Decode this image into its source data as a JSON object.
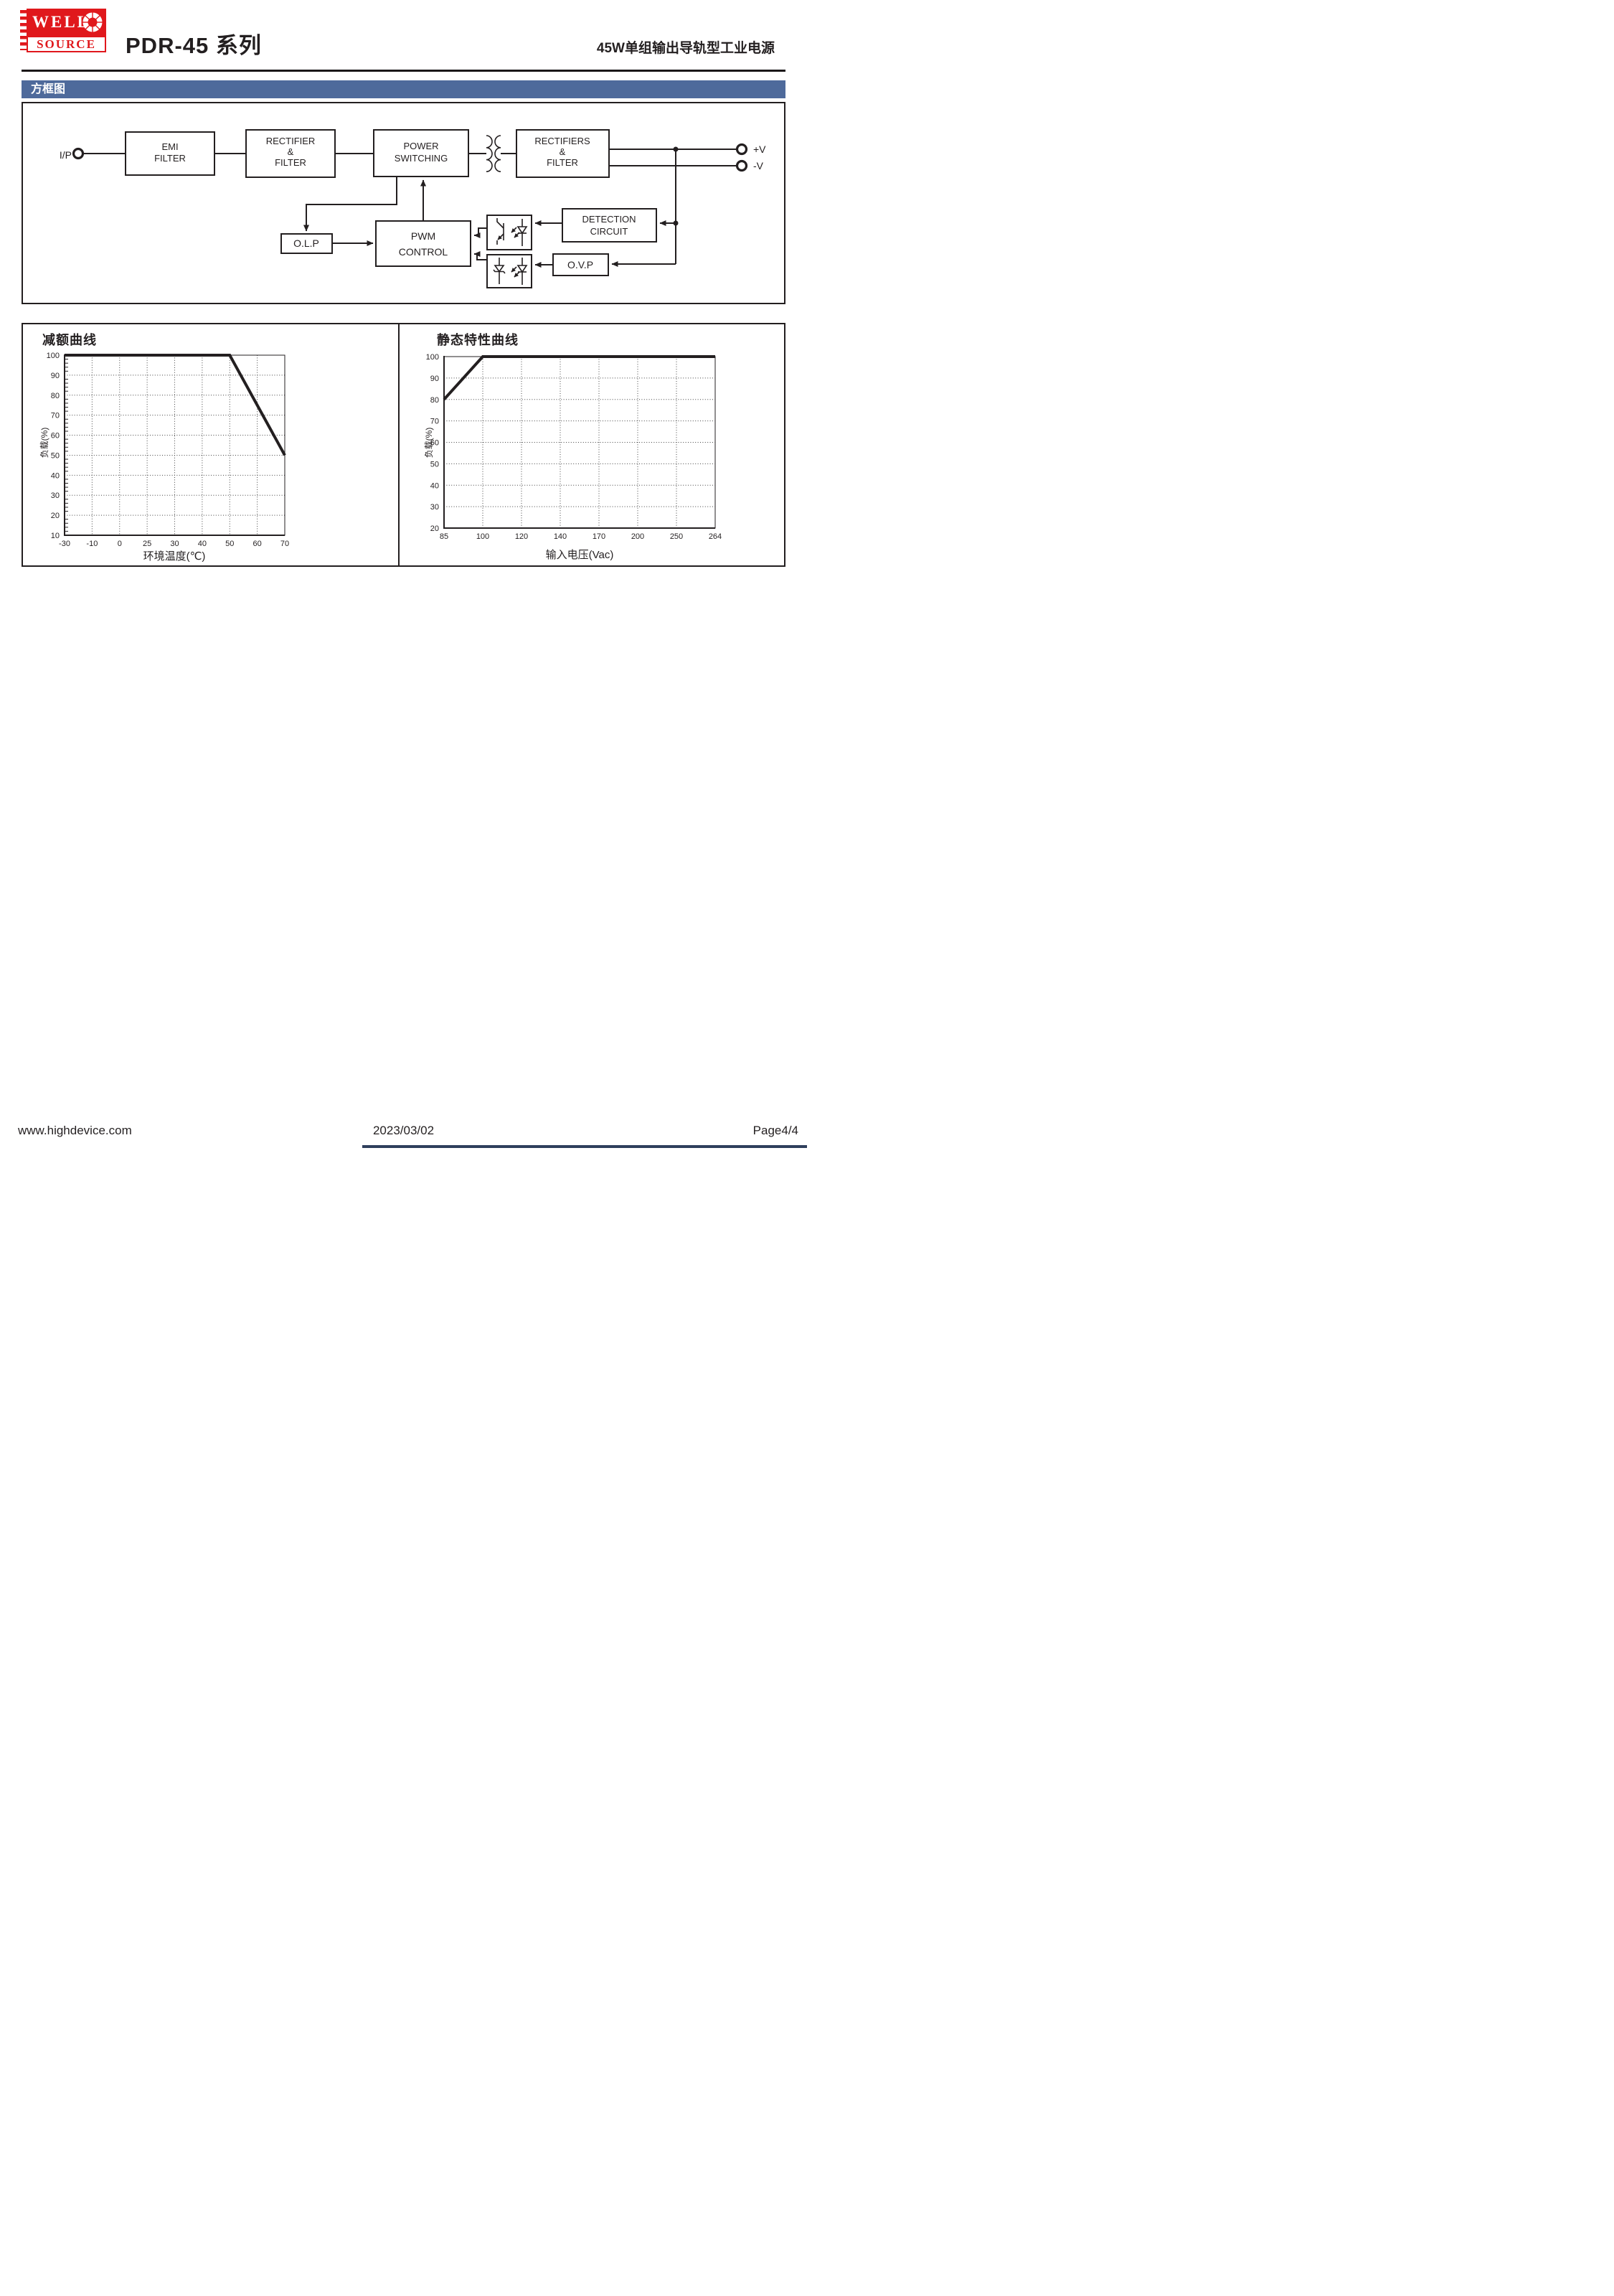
{
  "colors": {
    "ink": "#231f20",
    "banner_bg": "#4e6a9b",
    "banner_text": "#ffffff",
    "logo_red": "#e0181c",
    "grid_dots": "#444444"
  },
  "header": {
    "logo": {
      "word1": "WELL",
      "word2": "SOURCE"
    },
    "title": "PDR-45 系列",
    "subtitle": "45W单组输出导轨型工业电源"
  },
  "section_banner": "方框图",
  "diagram": {
    "input_label": "I/P",
    "emi_filter": {
      "l1": "EMI",
      "l2": "FILTER"
    },
    "rectifier_filter": {
      "l1": "RECTIFIER",
      "l2": "&",
      "l3": "FILTER"
    },
    "power_switching": {
      "l1": "POWER",
      "l2": "SWITCHING"
    },
    "rectifiers_filter": {
      "l1": "RECTIFIERS",
      "l2": "&",
      "l3": "FILTER"
    },
    "pwm_control": {
      "l1": "PWM",
      "l2": "CONTROL"
    },
    "olp": "O.L.P",
    "detection_circuit": {
      "l1": "DETECTION",
      "l2": "CIRCUIT"
    },
    "ovp": "O.V.P",
    "output_pos": "+V",
    "output_neg": "-V"
  },
  "chart_data": [
    {
      "type": "line",
      "title": "减额曲线",
      "xlabel": "环境温度(℃)",
      "ylabel": "负载(%)",
      "x_ticks": [
        "-30",
        "-10",
        "0",
        "25",
        "30",
        "40",
        "50",
        "60",
        "70"
      ],
      "y_ticks": [
        100,
        90,
        80,
        70,
        60,
        50,
        40,
        30,
        20,
        10
      ],
      "ylim": [
        10,
        100
      ],
      "x_axis_style": "ticks evenly spaced (categorical)",
      "grid": "dotted",
      "y_minor_tick_step": 2,
      "legend": "none",
      "series": [
        {
          "name": "load-vs-ambient-temperature",
          "points": [
            {
              "x": "-30",
              "load": 100
            },
            {
              "x": "50",
              "load": 100
            },
            {
              "x": "70",
              "load": 50
            }
          ]
        }
      ]
    },
    {
      "type": "line",
      "title": "静态特性曲线",
      "xlabel": "输入电压(Vac)",
      "ylabel": "负载(%)",
      "x_ticks": [
        "85",
        "100",
        "120",
        "140",
        "170",
        "200",
        "250",
        "264"
      ],
      "y_ticks": [
        100,
        90,
        80,
        70,
        60,
        50,
        40,
        30,
        20
      ],
      "ylim": [
        20,
        100
      ],
      "x_axis_style": "ticks evenly spaced (categorical)",
      "grid": "dotted",
      "y_minor_tick_step": null,
      "legend": "none",
      "series": [
        {
          "name": "load-vs-input-voltage",
          "points": [
            {
              "x": "85",
              "load": 80
            },
            {
              "x": "100",
              "load": 100
            },
            {
              "x": "264",
              "load": 100
            }
          ]
        }
      ]
    }
  ],
  "footer": {
    "website": "www.highdevice.com",
    "date": "2023/03/02",
    "page": "Page4/4"
  }
}
